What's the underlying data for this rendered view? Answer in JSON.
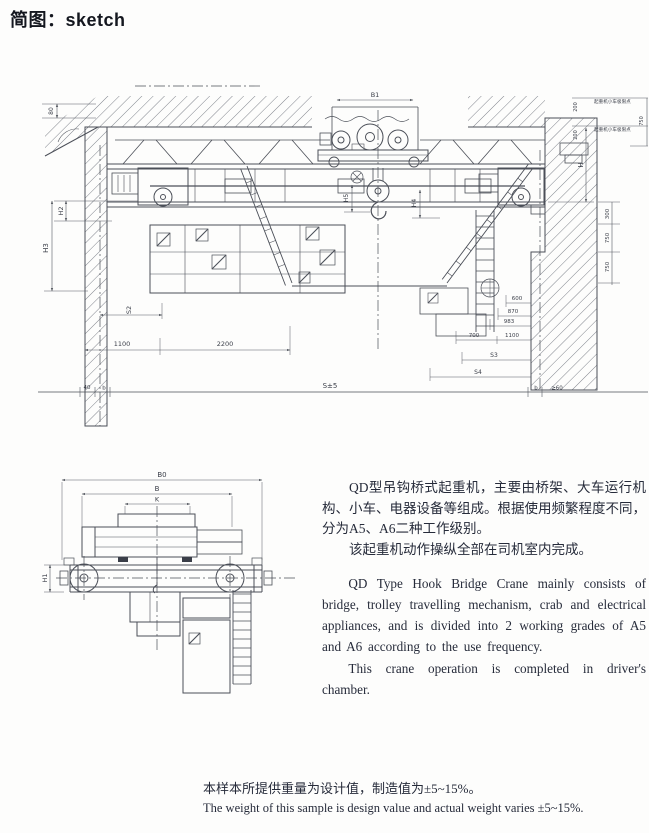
{
  "page": {
    "title": "简图：sketch"
  },
  "colors": {
    "ink": "#262b3a",
    "line": "#4b4f58",
    "dim": "#565a62"
  },
  "elev": {
    "dims": {
      "b1": "B1",
      "d80": "80",
      "h2": "H2",
      "h3": "H3",
      "s2": "S2",
      "d1100": "1100",
      "d2200": "2200",
      "h5": "H5",
      "h4": "H4",
      "span": "S±5",
      "d40": "40",
      "b_left": "b",
      "b_right": "b",
      "d60": "≥60",
      "d600": "600",
      "d870": "870",
      "d983": "983",
      "d700": "700",
      "d1100b": "1100",
      "s3": "S3",
      "s4": "S4",
      "h": "H",
      "d300": "300",
      "d750a": "750",
      "d750b": "750",
      "d200a": "200",
      "d200b": "200",
      "d750r": "750",
      "limit1": "起重机小车极限点",
      "limit2": "起重机小车极限点"
    }
  },
  "endview": {
    "dims": {
      "b0": "B0",
      "b": "B",
      "k": "K",
      "h1": "H1"
    }
  },
  "description": {
    "zh_para1": "QD型吊钩桥式起重机，主要由桥架、大车运行机构、小车、电器设备等组成。根据使用频繁程度不同，分为A5、A6二种工作级别。",
    "zh_para2": "该起重机动作操纵全部在司机室内完成。",
    "en_para1": "QD Type Hook Bridge Crane mainly consists of bridge, trolley travelling mechanism, crab and electrical appliances, and is divided into 2 working grades of A5 and A6 according to the use frequency.",
    "en_para2": "This crane operation is completed in driver's chamber."
  },
  "footnote": {
    "zh": "本样本所提供重量为设计值，制造值为±5~15%。",
    "en": "The weight of this sample is design value and actual weight varies ±5~15%."
  }
}
